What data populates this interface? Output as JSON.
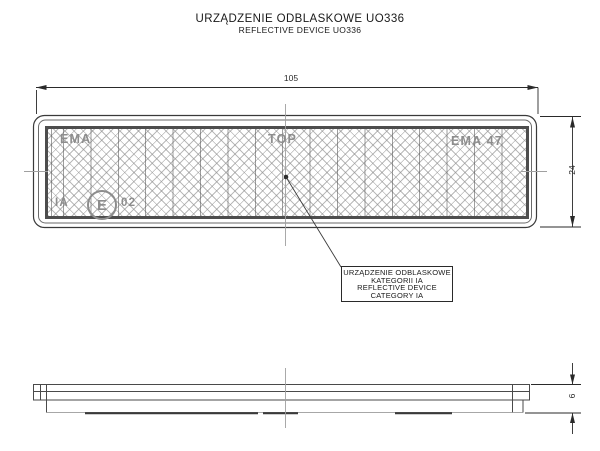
{
  "title": {
    "line1": "URZĄDZENIE ODBLASKOWE UO336",
    "line2": "REFLECTIVE DEVICE UO336"
  },
  "front_view": {
    "dim_width": "105",
    "dim_height": "24",
    "face_markings": {
      "left_brand": "EMA",
      "orientation": "TOP",
      "right_brand": "EMA 47",
      "category": "IA",
      "approval_letter": "E",
      "approval_number": "02"
    }
  },
  "side_view": {
    "dim_thickness": "6"
  },
  "callout": {
    "lines": [
      "URZĄDZENIE ODBLASKOWE",
      "KATEGORII IA",
      "REFLECTIVE DEVICE",
      "CATEGORY IA"
    ]
  },
  "colors": {
    "line": "#3a3a3a",
    "secondary_line": "#6a6a6a",
    "centerline": "#a0a0a0",
    "hatch": "#8c8c8c",
    "background": "#ffffff"
  }
}
